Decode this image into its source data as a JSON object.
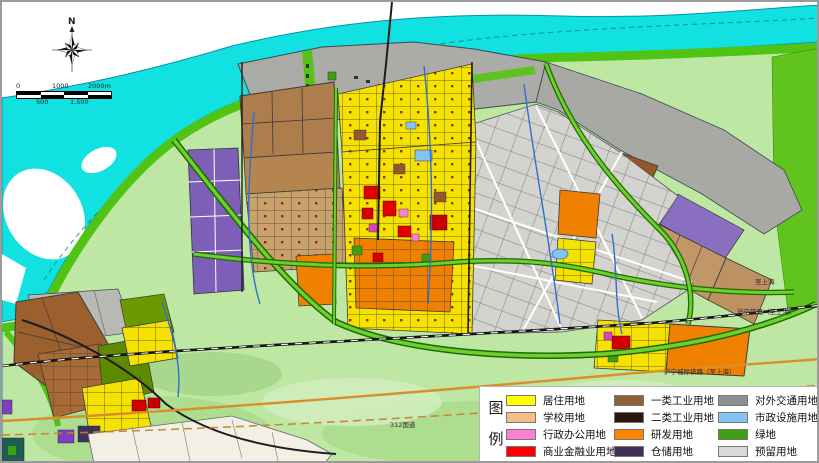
{
  "compass": {
    "north_label": "N"
  },
  "scale_bar": {
    "top_labels": [
      "0",
      "1000",
      "2000m"
    ],
    "bottom_labels": [
      "500",
      "1,500"
    ]
  },
  "map_labels": [
    {
      "text": "至上海"
    },
    {
      "text": "沪宁铁路（至上海）"
    },
    {
      "text": "沪宁城际铁路（至上海）"
    },
    {
      "text": "312国道"
    }
  ],
  "legend": {
    "title_chars": [
      "图",
      "例"
    ],
    "columns": [
      [
        {
          "label": "居住用地",
          "color": "#FFFF00"
        },
        {
          "label": "学校用地",
          "color": "#F5BE86"
        },
        {
          "label": "行政办公用地",
          "color": "#FC80D2"
        },
        {
          "label": "商业金融业用地",
          "color": "#FF0000"
        }
      ],
      [
        {
          "label": "一类工业用地",
          "color": "#8F6138"
        },
        {
          "label": "二类工业用地",
          "color": "#2A170B"
        },
        {
          "label": "研发用地",
          "color": "#FA8500"
        },
        {
          "label": "仓储用地",
          "color": "#413059"
        }
      ],
      [
        {
          "label": "对外交通用地",
          "color": "#8F8F8F"
        },
        {
          "label": "市政设施用地",
          "color": "#85C4F2"
        },
        {
          "label": "绿地",
          "color": "#3F9E14"
        },
        {
          "label": "预留用地",
          "color": "#D9D9D9"
        }
      ]
    ]
  },
  "map_colors": {
    "river": "#11E1E1",
    "shoreline_green": "#50C315",
    "land_base": "#BEE7A4",
    "boulevard_green": "#6FCE30",
    "intercity_rail_orange": "#D98E2B"
  }
}
